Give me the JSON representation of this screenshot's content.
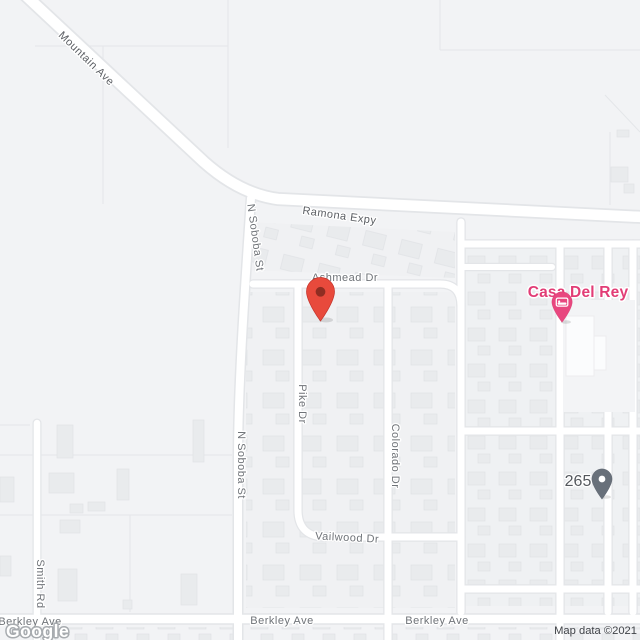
{
  "map": {
    "watermark": "Google",
    "attribution": "Map data ©2021",
    "streets": {
      "mountain_ave": "Mountain Ave",
      "ramona_expy": "Ramona Expy",
      "n_soboba_st": "N Soboba St",
      "ashmead_dr": "Ashmead Dr",
      "pike_dr": "Pike Dr",
      "colorado_dr": "Colorado Dr",
      "vailwood_dr": "Vailwood Dr",
      "smith_rd": "Smith Rd",
      "berkley_ave": "Berkley Ave"
    },
    "places": {
      "casa_del_rey": {
        "label": "Casa Del Rey",
        "color": "#e23d76",
        "pin_color": "#e8477f",
        "icon": "bed-lodging-icon"
      },
      "parcel_265": {
        "label": "265",
        "pin_color": "#68707a"
      }
    },
    "markers": {
      "destination": {
        "color": "#e84a3c",
        "inner_color": "#8f2d22"
      }
    },
    "colors": {
      "background": "#f2f3f5",
      "road_fill": "#ffffff",
      "road_casing": "#e3e5e8",
      "building": "#e9ebed",
      "street_label": "#6f7378"
    }
  }
}
